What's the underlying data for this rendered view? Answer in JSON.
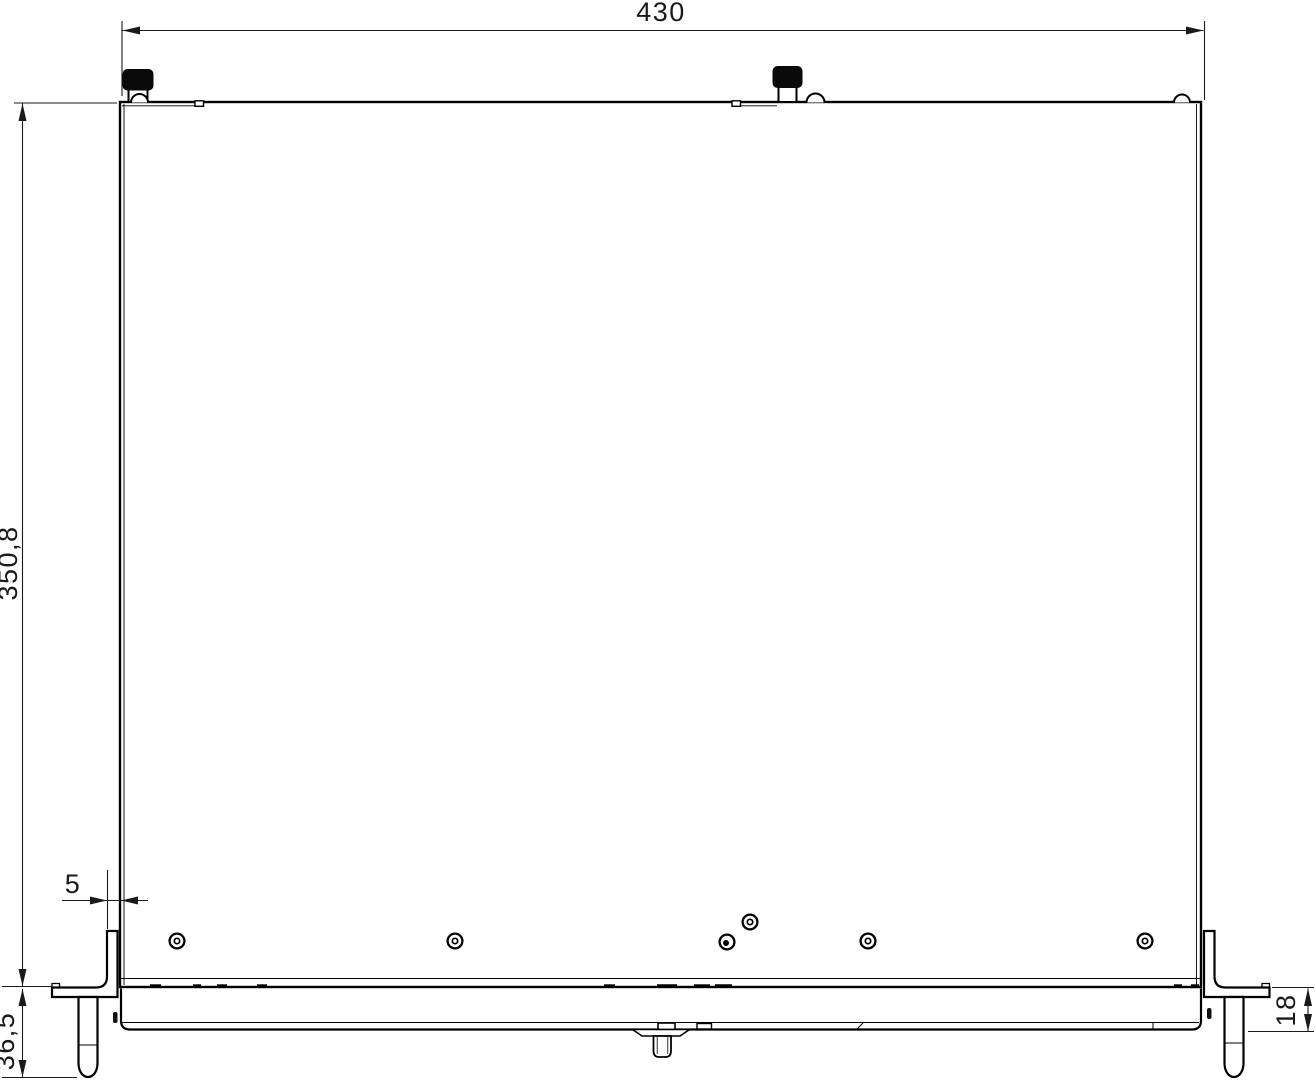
{
  "drawing": {
    "dimensions": {
      "overall_width": "430",
      "overall_depth": "350,8",
      "front_offset": "5",
      "foot_depth": "36,5",
      "bottom_height": "18"
    },
    "colors": {
      "line": "#000000",
      "dim": "#1a1a1a",
      "background": "#ffffff"
    }
  }
}
